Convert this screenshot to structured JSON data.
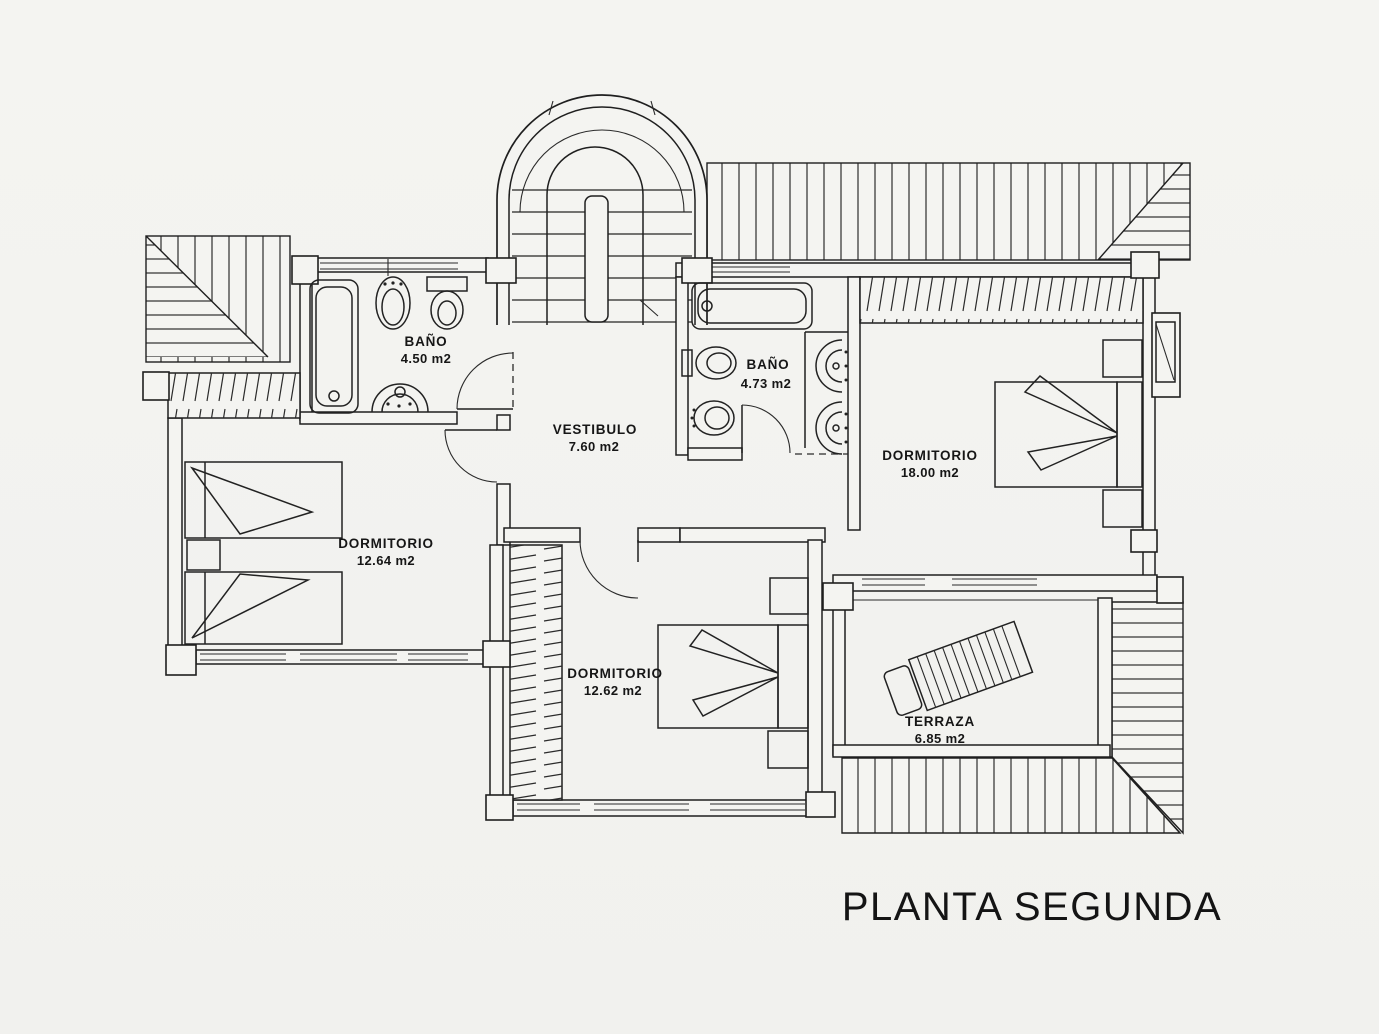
{
  "title": "PLANTA SEGUNDA",
  "rooms": [
    {
      "id": "bano-1",
      "name": "BAÑO",
      "area": "4.50 m2"
    },
    {
      "id": "vestibulo",
      "name": "VESTIBULO",
      "area": "7.60 m2"
    },
    {
      "id": "bano-2",
      "name": "BAÑO",
      "area": "4.73 m2"
    },
    {
      "id": "dormitorio-1",
      "name": "DORMITORIO",
      "area": "18.00 m2"
    },
    {
      "id": "dormitorio-2",
      "name": "DORMITORIO",
      "area": "12.64 m2"
    },
    {
      "id": "dormitorio-3",
      "name": "DORMITORIO",
      "area": "12.62 m2"
    },
    {
      "id": "terraza",
      "name": "TERRAZA",
      "area": "6.85 m2"
    }
  ],
  "fixtures": [
    "staircase",
    "bathtub",
    "toilet",
    "bidet",
    "washbasin",
    "double-bed",
    "twin-bed",
    "nightstand",
    "wardrobe",
    "lounge-chair",
    "door-swing",
    "window",
    "roof-hatch",
    "chimney"
  ],
  "colors": {
    "paper": "#f4f4f1",
    "ink": "#1f1f1f"
  }
}
